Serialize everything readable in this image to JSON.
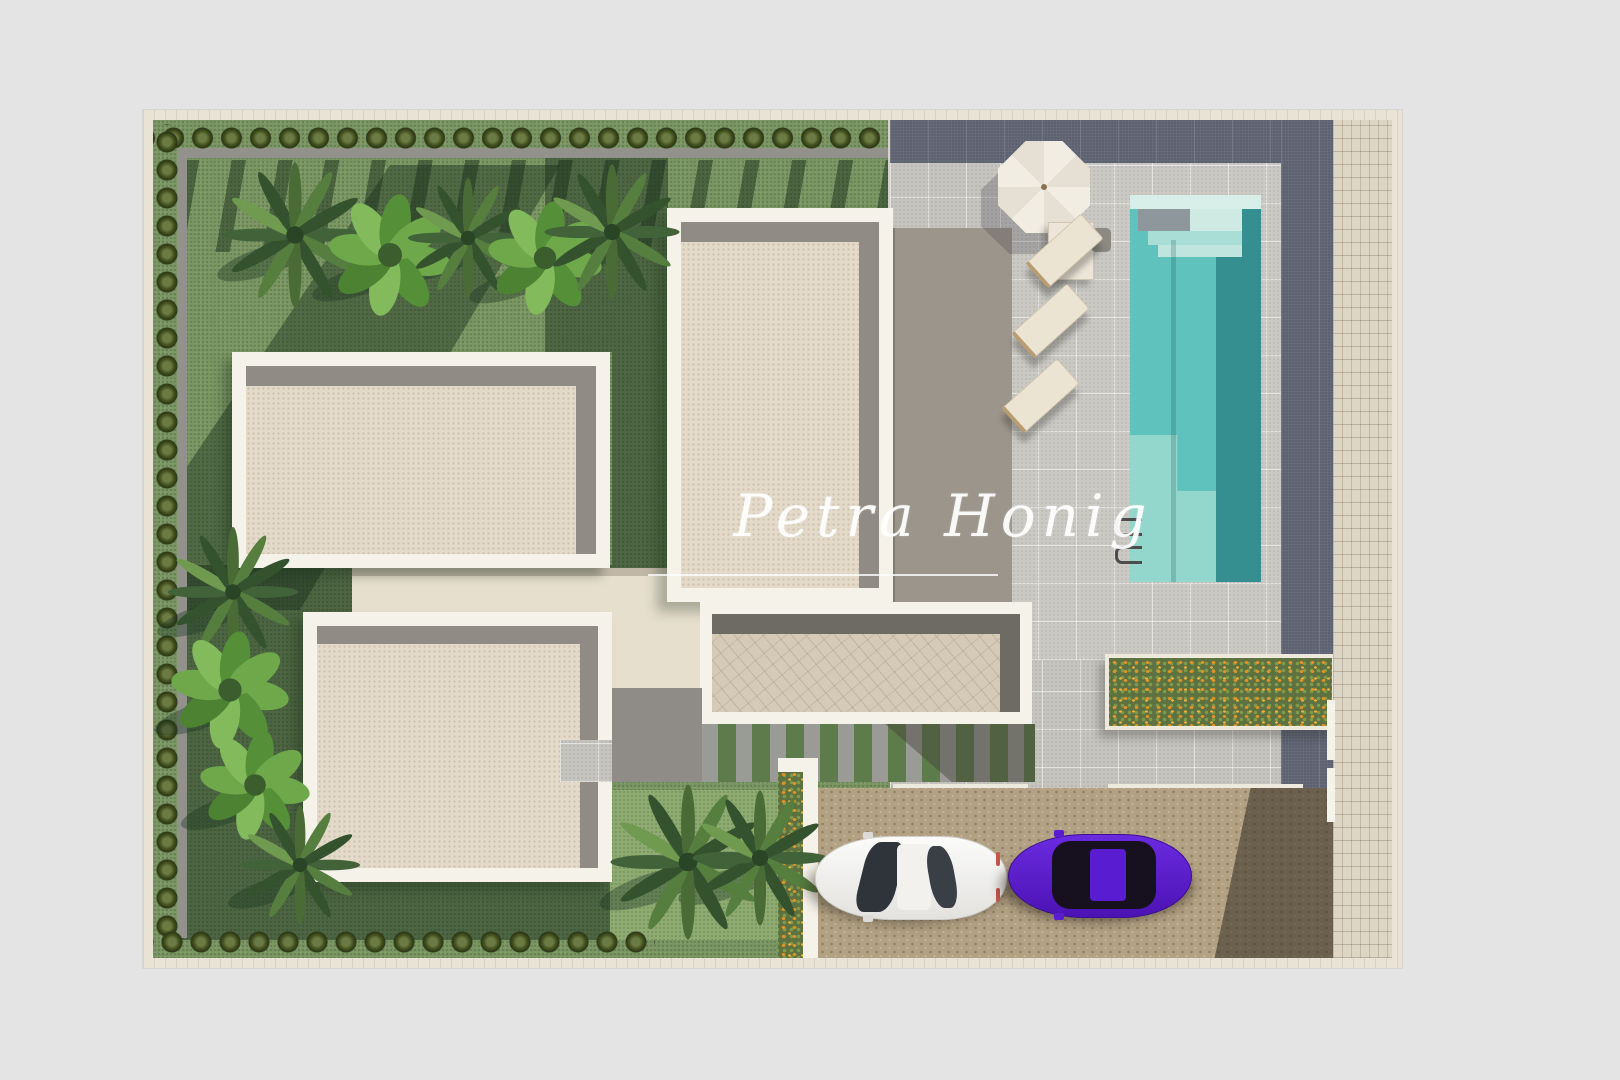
{
  "artwork": {
    "type": "aerial-3d-render",
    "subject": "villa site plan seen from above",
    "watermark": {
      "text": "Petra Honig"
    }
  },
  "palette": {
    "page_background": "#e4e4e5",
    "frame": "#e9e3d6",
    "lawn": "#7b9663",
    "lawn_shadow": "#2e4731",
    "hedge": "#3f521f",
    "roof_gravel": "#e3dac9",
    "roof_border": "#f5f2ea",
    "roof_band": "#908b85",
    "terrace": "#9c958b",
    "patio_tile": "#c6c4bf",
    "slate_band": "#5d6170",
    "pool_water": "#5fc2bd",
    "pool_deep": "#358f90",
    "pool_steps": "#d8eee8",
    "sidewalk": "#ddd6c5",
    "driveway": "#b2a183",
    "flowers": "#df9327",
    "umbrella": "#f1ece2",
    "lounger": "#ece4d3",
    "car_white": "#f6f6f5",
    "car_purple": "#5a1cd0"
  },
  "scene": {
    "buildings": [
      "upper-roof",
      "lower-roof",
      "main-villa-roof",
      "garage-roof"
    ],
    "pool": "rectangular pool with entry steps and ladder",
    "furniture": [
      "parasol",
      "side-table",
      "three-sun-loungers"
    ],
    "vehicles": [
      "white-car",
      "purple-car"
    ],
    "garden": [
      "perimeter-hedge",
      "palm-trees",
      "banana-plants",
      "flower-planters",
      "stepping-stone-path"
    ]
  }
}
